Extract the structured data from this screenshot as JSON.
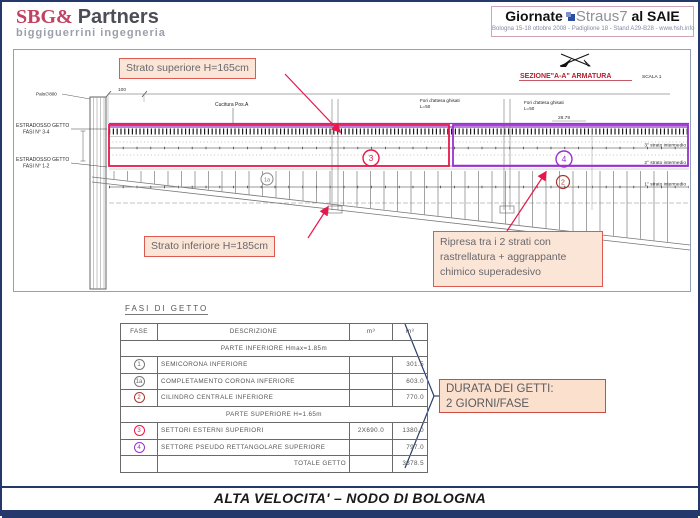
{
  "colors": {
    "accent_red": "#e8174b",
    "accent_purple": "#9b30d0",
    "dark_red": "#a5392f",
    "navy": "#24386b",
    "callout_bg": "#fbe5d6",
    "callout_border": "#dd5a52"
  },
  "header": {
    "sbg": {
      "part1": "SBG&",
      "part2": "Partners",
      "subtitle": "biggiguerrini ingegneria"
    },
    "giornate": {
      "word1": "Giornate",
      "word2": "Straus7",
      "word3": "al SAIE",
      "subtitle": "Bologna 15-18 ottobre 2008 - Padiglione 18 - Stand A29-B28 - www.hsh.info"
    }
  },
  "drawing": {
    "callout_top": "Strato superiore H=165cm",
    "callout_bottom": "Strato inferiore H=185cm",
    "callout_right": "Ripresa tra i 2 strati con rastrellatura + aggrappante chimico superadesivo",
    "section_title": "SEZIONE\"A-A\" ARMATURA",
    "scale": "SCALA 1",
    "estradosso1_l1": "ESTRADOSSO GETTO",
    "estradosso1_l2": "FASI N° 3-4",
    "estradosso2_l1": "ESTRADOSSO GETTO",
    "estradosso2_l2": "FASI N° 1-2",
    "palo": "Palo∅800",
    "cucitura": "Cucitura Pos.A",
    "fori_l1": "Fori d'attesa ghisati",
    "fori_l2": "L=50",
    "dim_100": "100",
    "dim_2879": "28.79",
    "strato3": "3° strato intermedio",
    "strato2": "2° strato intermedio",
    "strato1": "1° strato intermedio",
    "phase3": "3",
    "phase4": "4",
    "phase2": "2",
    "phase1a": "1a"
  },
  "table": {
    "title": "FASI DI GETTO",
    "headers": [
      "FASE",
      "DESCRIZIONE",
      "m³",
      "m³"
    ],
    "rows": [
      {
        "span": "PARTE INFERIORE Hmax=1.85m"
      },
      {
        "fase": "1",
        "desc": "SEMICORONA INFERIORE",
        "m3a": "",
        "m3b": "301.5"
      },
      {
        "fase": "1a",
        "desc": "COMPLETAMENTO CORONA INFERIORE",
        "m3a": "",
        "m3b": "603.0"
      },
      {
        "fase": "2",
        "desc": "CILINDRO CENTRALE INFERIORE",
        "m3a": "",
        "m3b": "770.0"
      },
      {
        "span": "PARTE SUPERIORE H=1.65m"
      },
      {
        "fase": "3",
        "desc": "SETTORI ESTERNI SUPERIORI",
        "m3a": "2X690.0",
        "m3b": "1380.0"
      },
      {
        "fase": "4",
        "desc": "SETTORE PSEUDO RETTANGOLARE SUPERIORE",
        "m3a": "",
        "m3b": "797.0"
      },
      {
        "total_label": "TOTALE GETTO",
        "m3b": "3878.5"
      }
    ]
  },
  "durata": {
    "line1": "DURATA  DEI GETTI:",
    "line2": "2 GIORNI/FASE"
  },
  "footer": {
    "title": "ALTA VELOCITA' – NODO DI BOLOGNA"
  }
}
